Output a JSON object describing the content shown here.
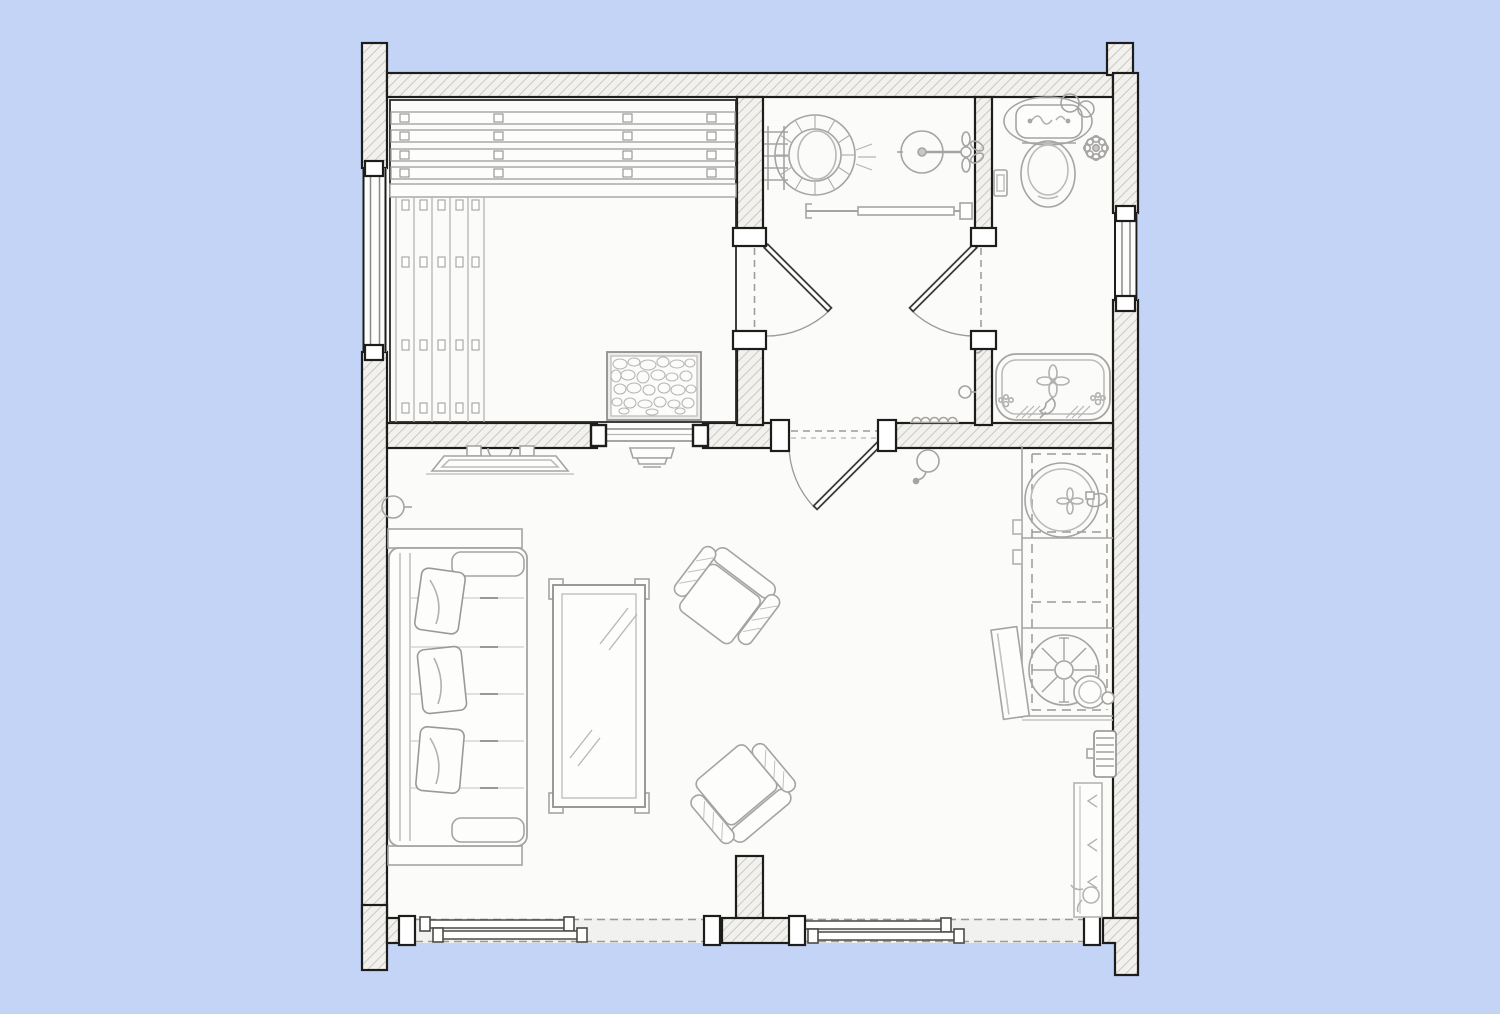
{
  "page": {
    "type": "architectural-floor-plan",
    "visible_text": []
  },
  "colors": {
    "background": "#c3d4f7",
    "paper": "#fbfbfa",
    "wall_fill": "#f2f1ee",
    "wall_hatch_line": "#c9c8c5",
    "outline": "#1d1d1b",
    "furniture_line": "#a5a4a2",
    "dark_fixture_line": "#8f8e8c",
    "door_leaf_line": "#3a3a38",
    "opening_fill": "#f1f1ef"
  },
  "rooms": [
    {
      "name": "sauna",
      "fixtures": [
        "tiered-benches",
        "duckboard-floor",
        "rock-heater",
        "pass-through-window",
        "step-heater"
      ]
    },
    {
      "name": "washroom",
      "fixtures": [
        "wooden-tub",
        "tub-ladder",
        "shower-mixer",
        "grab-bar",
        "doormat",
        "floor-drain"
      ]
    },
    {
      "name": "bathroom",
      "fixtures": [
        "toilet",
        "wall-valve",
        "toilet-brush-holder",
        "bathtub",
        "wall-hook"
      ]
    },
    {
      "name": "living-area",
      "fixtures": [
        "wall-tv",
        "sofa",
        "sofa-pillows",
        "coffee-table",
        "armchair-upper",
        "armchair-lower",
        "wall-lamp-left",
        "wall-lamp-right"
      ]
    },
    {
      "name": "kitchen",
      "fixtures": [
        "counter",
        "round-sink",
        "sink-faucet",
        "cooktop-fan",
        "pot",
        "leaning-board",
        "radiator",
        "planter"
      ]
    }
  ],
  "openings": {
    "hinged_doors": 3,
    "sliding_door_sets": 2,
    "windows": [
      "left-wall-window",
      "right-wall-window",
      "sauna-pass-through"
    ]
  }
}
